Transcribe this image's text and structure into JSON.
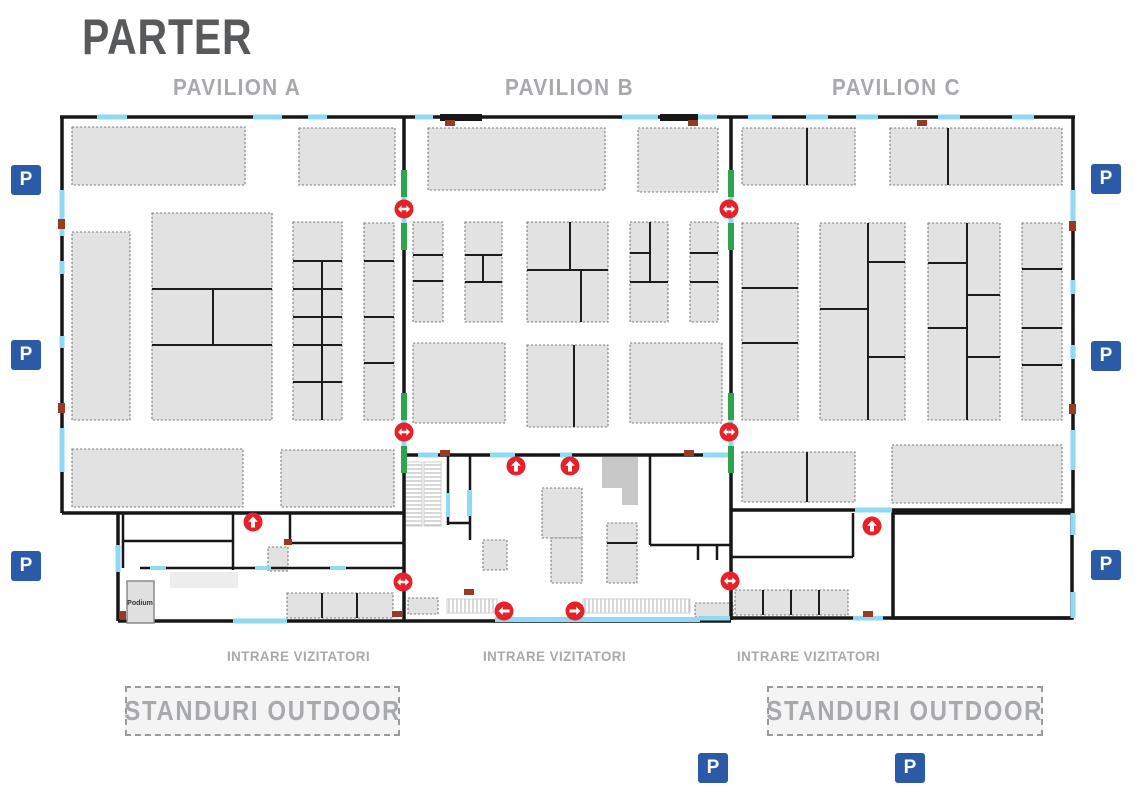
{
  "title": "PARTER",
  "pavilions": [
    {
      "label": "PAVILION A"
    },
    {
      "label": "PAVILION B"
    },
    {
      "label": "PAVILION C"
    }
  ],
  "labels": {
    "visitor_entrance": "INTRARE VIZITATORI",
    "outdoor_stands": "STANDURI OUTDOOR",
    "podium": "Podium",
    "parking": "P"
  },
  "icons": {
    "parking": "parking-icon",
    "up_arrow": "up-arrow-icon",
    "two_way_arrow": "two-way-arrow-icon",
    "left_arrow": "left-arrow-icon",
    "right_arrow": "right-arrow-icon"
  },
  "colors": {
    "title_text": "#58595b",
    "pavilion_text": "#a7a9ac",
    "stand_fill": "#e2e2e3",
    "wall": "#171717",
    "door_opening_blue": "#8fd9f3",
    "passage_green": "#2da44e",
    "arrow_red": "#e62129",
    "parking_blue": "#2b5aa7",
    "outdoor_box_fill": "#f4f4f4"
  }
}
